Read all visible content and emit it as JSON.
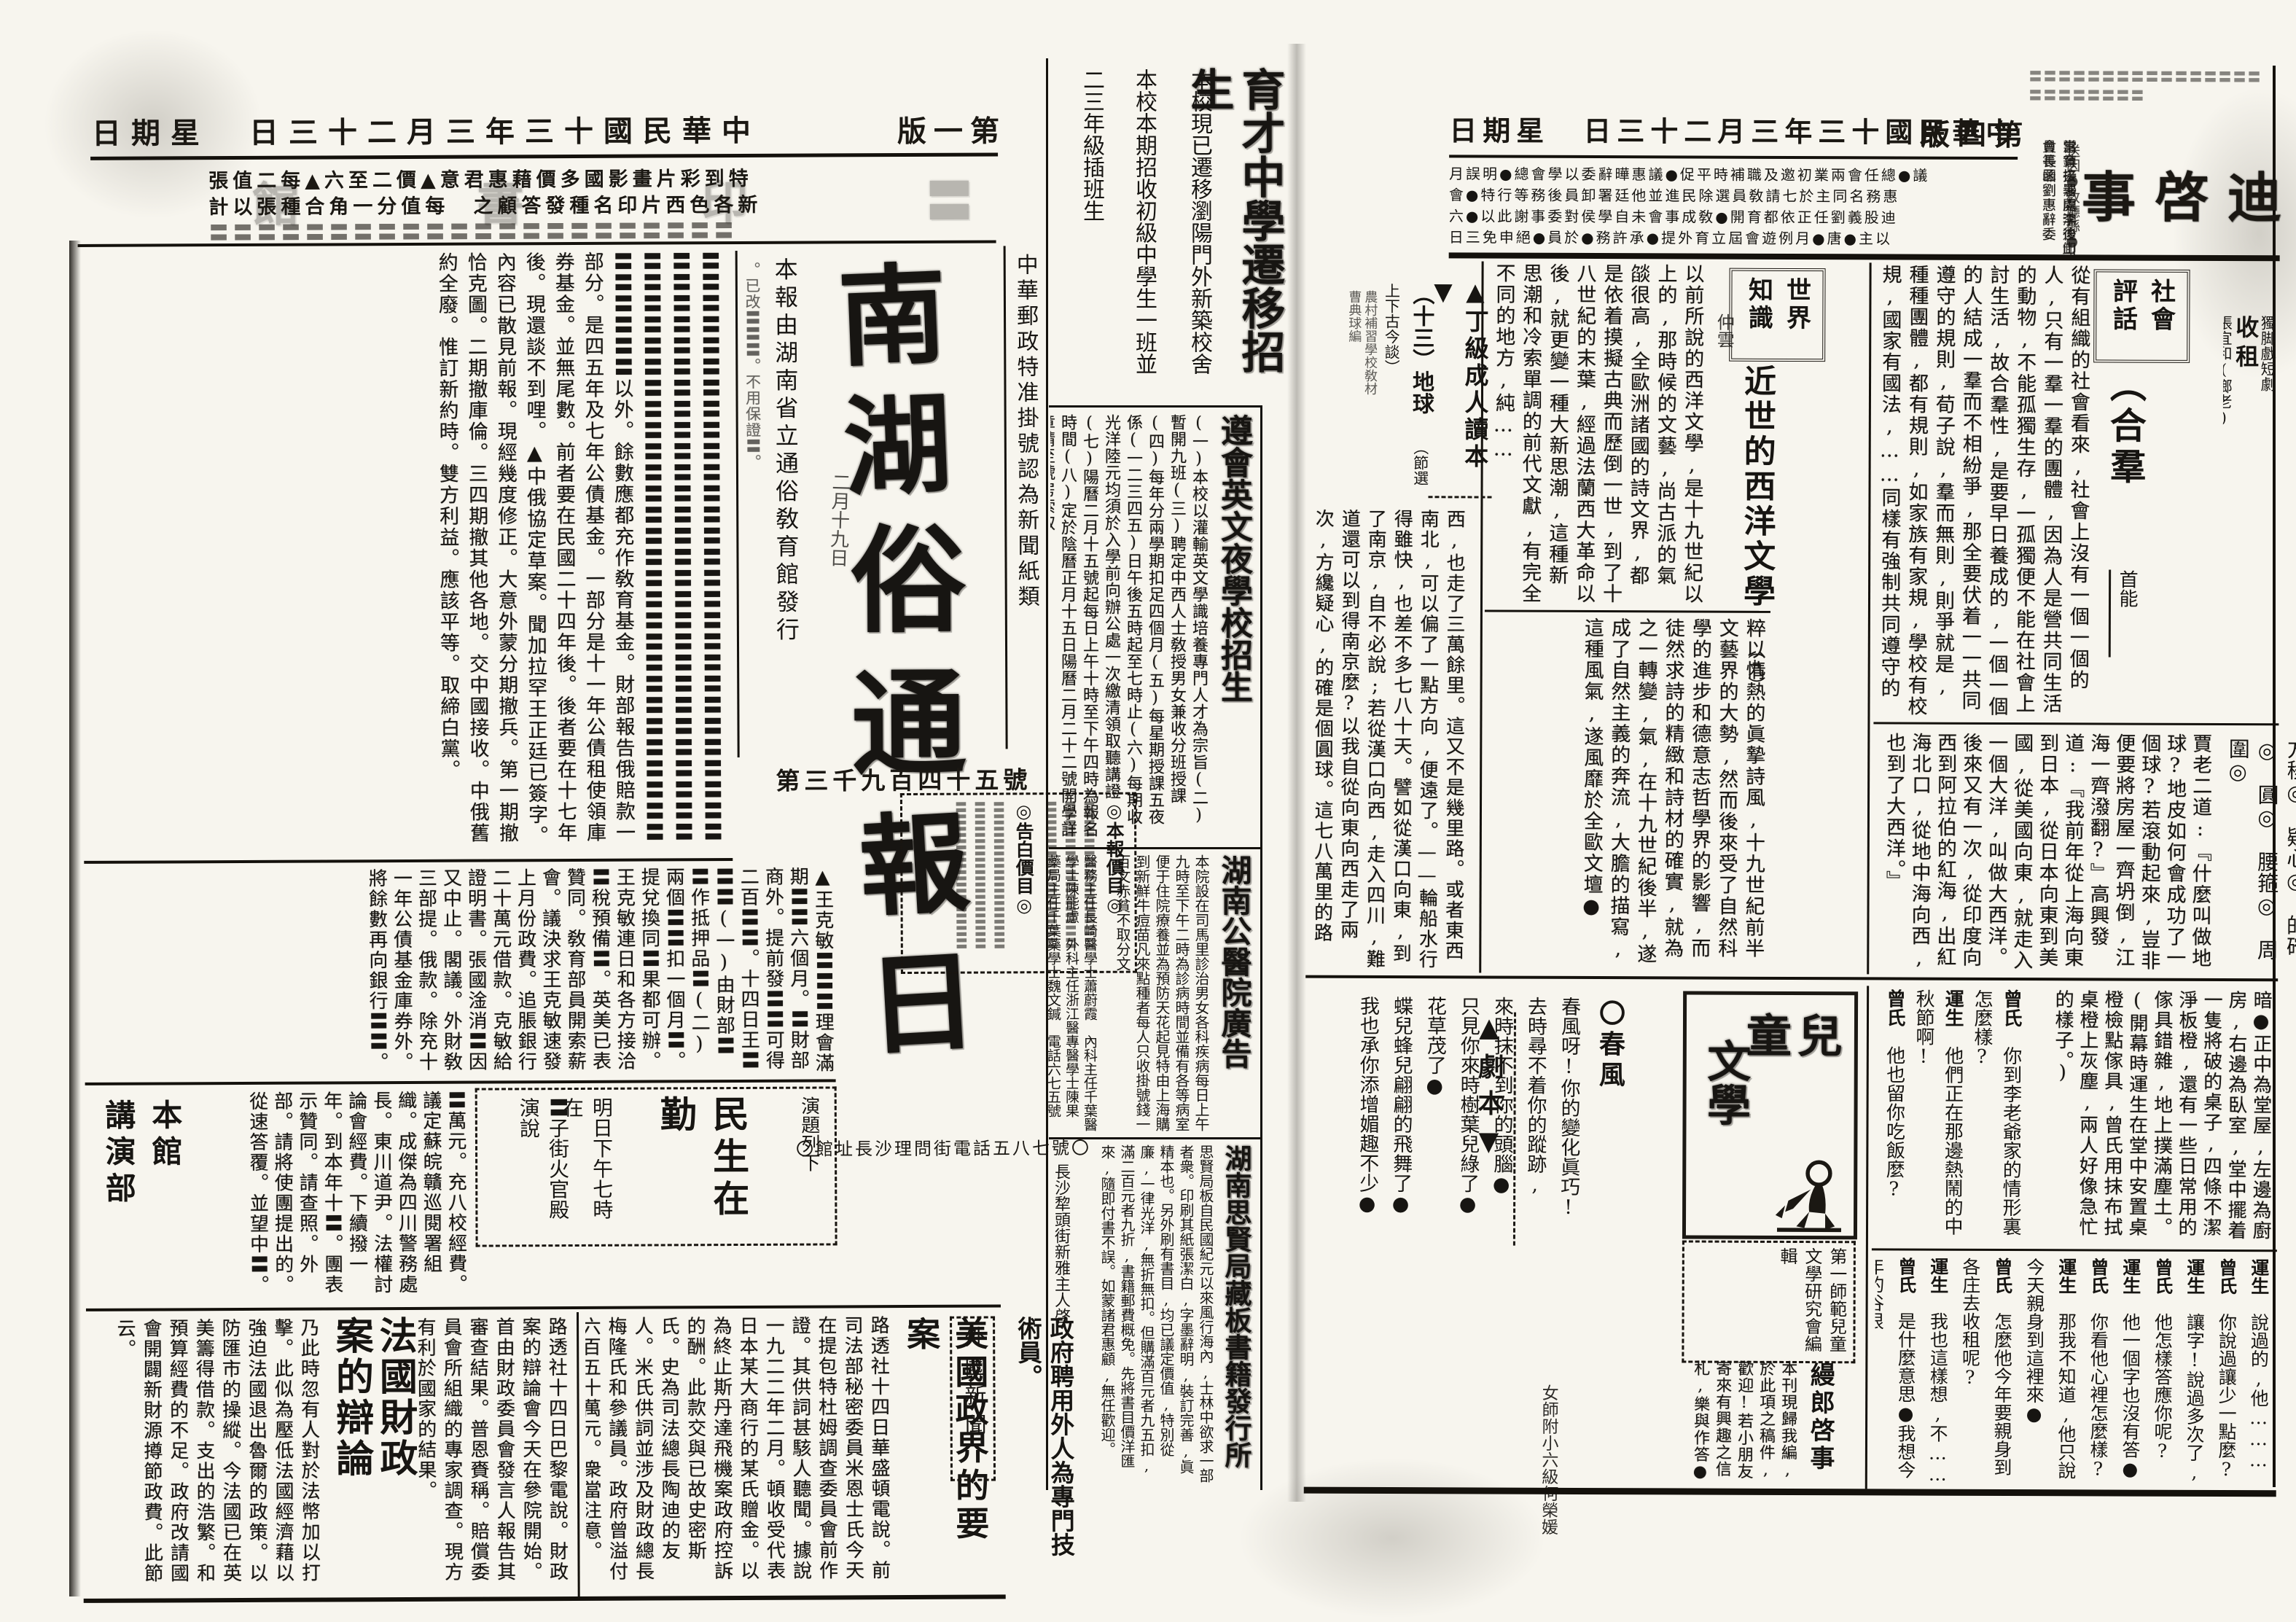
{
  "colors": {
    "paper": "#f7f5ee",
    "ink": "#1b1813"
  },
  "left_header": {
    "date_rtl": "日期星　日三十二月三年三十國民華中",
    "page_label_rtl": "版一第"
  },
  "right_header": {
    "date_rtl": "日期星　日三十二月三年三十國民華中",
    "page_label_rtl": "版四第"
  },
  "banner_ad": {
    "row1": "張值二每▲六至二價▲意君惠藉價多國影畫片彩到特",
    "row2": "計以張種合角一分值每　之顧答發種名印片西色各新",
    "row3": "〓〓〓〓〓〓〓〓〓〓〓〓〓〓〓〓〓〓〓〓〓〓",
    "faint_name_rtl": "館　書　印　〓　〓"
  },
  "masthead": {
    "postal_note": "中華郵政特准掛號認為新聞紙類",
    "pairs_rtl": [
      "南湖",
      "俗通",
      "報日"
    ],
    "date_script": "二月十九日",
    "publisher_note": "本報由湖南省立通俗敎育館發行",
    "side_note": "。已改〓〓〓。不用保證〓。",
    "issue_no": "第三千九百四十五號"
  },
  "rates_box": {
    "title_a": "◎本報價目◎",
    "title_b": "◎告白價目◎",
    "cols": [
      "〓〓〓〓〓〓〓〓〓〓〓〓",
      "〓〓〓〓〓〓〓〓〓〓〓〓",
      "〓〓〓〓〓〓〓〓〓〓〓〓",
      "〓〓〓〓〓〓〓〓〓〓〓〓",
      "〓〓〓〓〓〓〓〓〓〓〓〓",
      "〓〓〓〓〓〓〓〓〓〓〓〓"
    ]
  },
  "address_line": "〇館址長沙理問街電話五八七號〇",
  "band1_article": "〓〓〓〓〓〓〓〓〓〓〓〓〓〓〓〓〓〓〓〓〓〓〓〓〓〓〓〓〓〓〓〓〓〓〓〓〓〓〓〓〓〓〓〓〓〓〓〓〓〓〓〓〓〓〓〓〓〓〓〓〓〓〓〓〓〓〓〓〓〓〓〓〓〓〓〓〓〓〓〓〓〓〓〓〓〓〓〓〓〓以外。餘數應都充作敎育基金。財部報告俄賠款一部分。是四五年及七年公債基金。一部分是十一年公債租使領庫券基金。並無尾數。前者要在民國二十四年後。後者要在十七年後。現還談不到哩。▲中俄協定草案。聞加拉罕王正廷已簽字。內容已散見前報。現經幾度修正。大意外蒙分期撤兵。第一期撤恰克圖。二期撤庫倫。三四期撤其他各地。交中國接收。中俄舊約全廢。惟訂新約時。雙方利益。應該平等。取締白黨。",
  "band2_article": "▲王克敏〓〓〓理會滿期〓〓六個月。〓財部商外。提前發〓〓可得二百〓〓。十四日王〓〓〓(一)由財部〓〓作抵押品〓(二)兩個〓〓扣一個月〓。提兌換同〓果都可辦。王克敏連日和各方接洽〓稅預備〓。英美已表贊同。敎育部員開索薪會。議決求王克敏速發上月份政費。追脹銀行二十萬元借款。克敏給證明書。張國淦消〓因又中止。閣議。外財敎三部提。俄款。除充十一年公債基金庫券外。將餘數再向銀行〓〓。",
  "band3_article": "〓萬元。充八校經費。議定蘇皖贛巡閱署組織。成傑為四川警務處長。東川道尹。法權討論會經費。下續撥一年。到本年十〓。團表示贊同。請查照。外部。請將使團提出的。從速答覆。並望中〓。",
  "lecture_box": {
    "label": "演題列下",
    "topic": "民生在勤",
    "line1": "明日下午七時在",
    "line2": "〓子街火官殿演說"
  },
  "section_sig": {
    "right": "本館",
    "left": "講演部"
  },
  "french": {
    "title": "法國財政案的辯論",
    "lead": "路透社十四日巴黎電說。財政案的辯論會今天在參院開始。首由財政委員會發言人報告其審查結果。普恩賚稱。賠償委員會所組織的專家調查。現方有利於國家的結果。",
    "tail": "乃此時忽有人對於法幣加以打擊。此似為壓低法國經濟藉以強迫法國退出魯爾的政策。以防匯市的操縱。今法國已在英美籌得借款。支出的浩繁。和預算經費的不足。政府改請國會開闢新財源撙節政費。此節云。"
  },
  "us": {
    "title": "美國政界的要案",
    "text": "路透社十四日華盛頓電說。前司法部秘密委員米恩士氏今天在提包特杜姆調查委員會前作證。其供詞甚駭人聽聞。據說一九二二年二月。頓收受代表日本某大商行的某氏贈金。以為終止斯丹達飛機案政府控訴的酬。此款交與已故史密斯氏。史為司法總長陶迪的友人。米氏供詞並涉及財政總長梅隆氏和參議員。政府曾溢付六百五十萬元。衆當注意。"
  },
  "foreign_label": "外國新聞",
  "gov_brief": "政府聘用外人為專門技術員。",
  "gutter": {
    "g1": {
      "headline": "育才中學遷移招生",
      "sub": "本校現已遷移瀏陽門外新築校舍",
      "body1": "本校本期招收初級中學生一班並",
      "body2": "二三年級插班生"
    },
    "g2": {
      "headline": "遵會英文夜學校招生",
      "body": "(一)本校以灌輸英文學識培養專門人才為宗旨(二)暫開九班(三)聘定中西人士敎授男女兼收分班授課(四)每年分兩學期扣足四個月(五)每星期授課五夜係(一二三四五)日午後五時起至七時止(六)每期收光洋陸元均須於入學前向辦公處一次繳清領取聽講證(七)陽曆二月十五號起每日上午十時至下午四時為報名時間(八)定於陰曆正月十五日陽曆二月二十二號開學詳章請至號房索取"
    },
    "g3": {
      "headline": "湖南公醫院廣告",
      "body": "本院設在司馬里診治男女各科疾病每日上午九時至下午二時為診病時間並備有各等病室便于住院療養並為預防天花起見特由上海購到新鮮牛痘苗凡來點種者每人只收掛號錢一百文赤貧不取分文",
      "staff": "醫務主任長崎醫學士蕭蔚霞　內科主任千葉醫學士陳能慮　外科主任浙江醫專醫學士陳果　藥局主任千葉藥學士魏文鍼　電話六七五號"
    },
    "g4": {
      "headline": "湖南思賢局藏板書籍發行所",
      "body": "思賢局板自民國紀元以來風行海內,士林中欲求一部者衆。印刷其紙張潔白,字墨辭明,裝訂完善,眞精本也。另外刷有書目,均已議定價值,特別從廉,一律光洋,無折無扣。但購滿百元者九五扣,滿二百元者九折,書籍郵費概免。先將書目價洋匯來,隨即付書不誤。如蒙諸君惠顧,無任歡迎。",
      "sig": "長沙犂頭街新雅主人啓"
    }
  },
  "liheidi": {
    "headline_rtl": "事啓迪惠李",
    "top_filler": "〓〓〓〓〓〓〓〓〓〓〓〓〓〓〓〓〓〓〓〓〓〓〓〓",
    "side_cols": [
      "當育接署處李後山會長函劉惠辭委",
      "惠鎮去沙開鴻迪卸員等罪",
      "送因●敎廳縣●詠先學●"
    ],
    "grid_rows": [
      "月誤明●總會學以委辭曄惠議●促平時補職及邀初業兩會任總●議",
      "會●特行等務後員卸署廷他並進民除選員敎請七於主同名務惠",
      "六●以此謝事委對侯學自未會事成敎●開育都依正任劉義股迪",
      "日三免申絕●員於●務許承●提外育立屆會遊例月●唐●主以"
    ]
  },
  "shouzu": {
    "label": "獨脚戲短劇",
    "title": "收租",
    "cast": [
      "張宜和(鄉老)",
      "菊秀(運生女)",
      "劉春圃"
    ],
    "scene": "佈景　一個田莊,一廢四壁,牆有窗的房子,日光下看去,房內非常黑暗●"
  },
  "shehui": {
    "box_label": "社會評話",
    "title": "（合羣",
    "author": "首能",
    "text": "從有組織的社會看來,社會上沒有一個一個的人,只有一羣一羣的團體,因為人是營共同生活的動物,不能孤獨生存,一孤獨便不能在社會上討生活,故合羣性,是要早日養成的,一個一個的人結成一羣而不相紛爭,那全要伏着一一共同遵守的規則,荀子說,羣而無則,則爭就是,種種團體,都有規則,如家族有家規,學校有校規,國家有國法,……同樣有強制共同遵守的效力,因凡是有組織的團體,其行動多是團體的行動,總有些兒的妨害的,然而為合羣起見,不能不稍微遷就些兒啊!"
  },
  "vocab": "方稜◎　疑心◎　的確◎　圓◎　腰箍◎　周圍◎",
  "dili_dialogue": "賈老二道:『什麼叫做地球?地皮如何會成功了一個球?若滾動起來,豈非便要將房屋一齊坍倒,江海一齊潑翻?』高興發道:『我前年從上海向東到日本,從日本向東到美國,從美國向東,就走入一個大洋,叫做大西洋。後來又有一次,從印度向西到阿拉伯的紅海,出紅海北口,從地中海向西,也到了大西洋。』",
  "shijie": {
    "box_label": "世界知識",
    "title": "近世的西洋文學",
    "part": "（九）",
    "author": "仲雲",
    "part1": "以前所說的西洋文學,是十九世紀以上的,那時候的文藝,尚古派的氣燄很高,全歐洲諸國的詩文界,都是依着摸擬古典而歷倒一世,到了十八世紀的末葉,經過法蘭西大革命以後,就更變一種大新思潮,這種新思潮和冷索單調的前代文獻,有完全不同的地方,純……",
    "part2": "粹以情熱的眞摯詩風,十九世紀前半文藝界的大勢,然而後來受了自然科學的進步和德意志哲學界的影響,而徒然求詩的精緻和詩材的確實,就為之一轉變,氣,在十九世紀後半,遂成了自然主義的奔流,大膽的描寫,這種風氣,遂風靡於全歐文壇●"
  },
  "dingji": {
    "marker": "▲丁級成人讀本▼",
    "lesson_no": "（十三）地球",
    "sub": "（節選上下古今談）",
    "tiny1": "農村補習學校敎材",
    "tiny2": "曹典球編",
    "text": "西,也走了三萬餘里。這又不是幾里路。或者東西南北,可以偏了一點方向,便遠了。——輪船水行得雖快,也差不多七八十天。譬如從漢口向東,到了南京,自不必說;若從漢口向西,走入四川,難道還可以到得南京麼?以我自從向東向西走了兩次,方纔疑心,的確是個圓球。這七八萬里的路程,便是地球的周圍,來有如此大小。—"
  },
  "juben_marker": "▲劇本▼",
  "play": {
    "stage": "暗●正中為堂屋,左邊為廚房,右邊為臥室,堂中擺着一隻將破的桌子,四條不潔淨板橙,還有一些日常用的傢具錯雜,地上撲滿塵土。(開幕時運生在堂中安置桌橙檢點傢具,曾氏用抹布拭桌橙上灰塵,兩人好像急忙的樣子。)",
    "d1": [
      {
        "s": "曾氏",
        "t": "你到李老爺家的情形裏怎麼樣?"
      },
      {
        "s": "運生",
        "t": "他們正在那邊熱鬧的中秋節啊!"
      },
      {
        "s": "曾氏",
        "t": "他也留你吃飯麼?"
      }
    ],
    "d2": [
      {
        "s": "運生",
        "t": "說過的,他………"
      },
      {
        "s": "曾氏",
        "t": "你說過讓少一點麼?"
      },
      {
        "s": "運生",
        "t": "讓字!說過多次了,"
      },
      {
        "s": "曾氏",
        "t": "他怎樣答應你呢?"
      },
      {
        "s": "運生",
        "t": "他一個字也沒有答●"
      },
      {
        "s": "曾氏",
        "t": "你看他心裡怎麼樣?"
      },
      {
        "s": "運生",
        "t": "那我不知道,他只說今天親身到這裡來●"
      },
      {
        "s": "曾氏",
        "t": "怎麼他今年要親身到各庄去收租呢?"
      },
      {
        "s": "運生",
        "t": "我也這樣想,不……"
      },
      {
        "s": "曾氏",
        "t": "是什麼意思●我想今年的谷很"
      }
    ]
  },
  "ertong": {
    "logo_pair_rtl": "童兒",
    "logo_word2": "文學",
    "editor": "第一師範兒童文學研究會編輯",
    "manlang_title": "縵郎啓事",
    "manlang_text": "本刊現歸我編,於此項之稿件,歡迎!若小朋友寄來有興趣之信札,樂與作答●"
  },
  "poem": {
    "title": "〇春風",
    "lines": [
      "春風呀!你的變化眞巧!",
      "去時尋不着你的蹤跡,",
      "來時抹不到你的頭腦●",
      "只見你來時樹葉兒綠了●",
      "花草茂了●",
      "蝶兒蜂兒翩翩的飛舞了●",
      "我也承你添增媚趣不少●"
    ],
    "sig": "女師附小六級何榮媛"
  }
}
